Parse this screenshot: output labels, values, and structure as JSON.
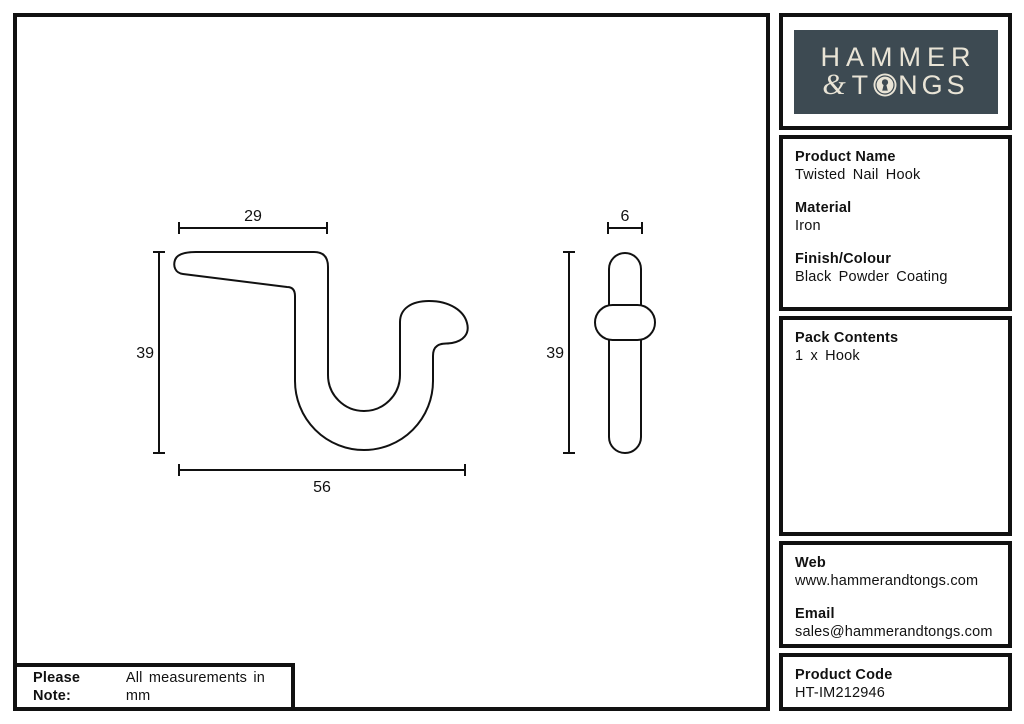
{
  "logo": {
    "line1": "HAMMER",
    "ampersand": "&",
    "line2_before_o": "T",
    "line2_after_o": "NGS",
    "bg_color": "#3d4a52",
    "text_color": "#e9e4d6"
  },
  "sidebar": {
    "product_name": {
      "label": "Product Name",
      "value": "Twisted Nail Hook"
    },
    "material": {
      "label": "Material",
      "value": "Iron"
    },
    "finish_colour": {
      "label": "Finish/Colour",
      "value": "Black Powder Coating"
    },
    "pack_contents": {
      "label": "Pack Contents",
      "value": "1 x Hook"
    },
    "web": {
      "label": "Web",
      "value": "www.hammerandtongs.com"
    },
    "email": {
      "label": "Email",
      "value": "sales@hammerandtongs.com"
    },
    "product_code": {
      "label": "Product Code",
      "value": "HT-IM212946"
    }
  },
  "note": {
    "label": "Please Note:",
    "text": "All measurements in mm"
  },
  "drawing": {
    "line_color": "#111111",
    "side_view": {
      "top_width": "29",
      "height": "39",
      "bottom_width": "56"
    },
    "front_view": {
      "width": "6",
      "height": "39"
    }
  }
}
